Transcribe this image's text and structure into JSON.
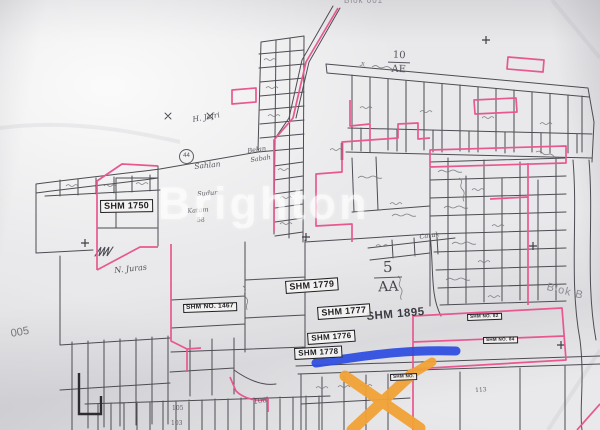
{
  "image_type": "photograph of a hand-drawn cadastral land-parcel map with highlighter annotations",
  "watermark": {
    "text": "Brighton"
  },
  "labels": {
    "blok_top": "Blok 001",
    "road_top": "Jl.",
    "block_ae_num": "10",
    "block_ae_code": "AE",
    "block_aa_num": "5",
    "block_aa_code": "AA",
    "shm_1750": "SHM 1750",
    "shm_no_1467": "SHM NO. 1467",
    "shm_1779": "SHM 1779",
    "shm_1777": "SHM 1777",
    "shm_1776": "SHM 1776",
    "shm_1778": "SHM 1778",
    "shm_1895": "SHM 1895",
    "shm_no_82": "SHM NO. 82",
    "shm_no_84": "SHM NO. 84",
    "shm_no_x": "SHM NO.",
    "area_left": "005",
    "blok_right": "Blok B",
    "name_jafri": "H. Jafri",
    "name_sahlan": "Sahlan",
    "name_sudur": "Sudur",
    "name_katam": "Katam",
    "name_belan": "Belan",
    "name_sabah": "Sabah",
    "name_juras": "N. Juras",
    "name_caruk": "Caruk",
    "num_44": "44",
    "num_58": "58",
    "num_103": "103",
    "num_105": "105",
    "num_106": "106",
    "num_113": "113"
  },
  "annotations": {
    "blue_marker": "thick blue highlighter line over road",
    "orange_x_marker": "orange X crossing out a parcel",
    "colors": {
      "blue": "#2a4be0",
      "orange": "#f2a236",
      "pink_boundary": "#e8588f",
      "ink": "#4c4c52"
    }
  }
}
